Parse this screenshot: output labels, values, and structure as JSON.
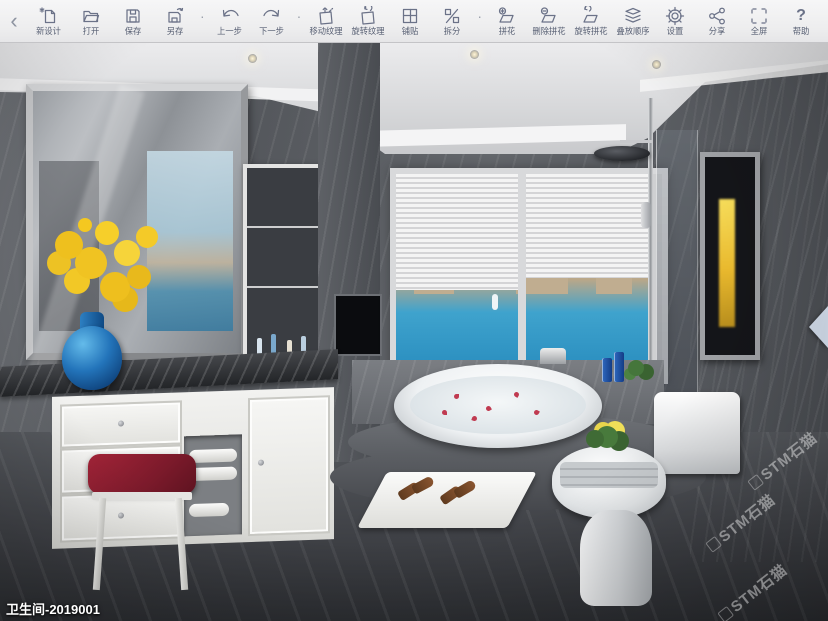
{
  "window": {
    "width": 828,
    "height": 621
  },
  "toolbar": {
    "back_glyph": "‹",
    "separator_glyph": "·",
    "help_glyph": "?",
    "groups": [
      {
        "items": [
          {
            "label": "新设计",
            "icon": "new-design-icon"
          },
          {
            "label": "打开",
            "icon": "open-folder-icon"
          },
          {
            "label": "保存",
            "icon": "save-icon"
          },
          {
            "label": "另存",
            "icon": "save-as-icon"
          }
        ]
      },
      {
        "items": [
          {
            "label": "上一步",
            "icon": "undo-icon"
          },
          {
            "label": "下一步",
            "icon": "redo-icon"
          }
        ]
      },
      {
        "items": [
          {
            "label": "移动纹理",
            "icon": "move-texture-icon"
          },
          {
            "label": "旋转纹理",
            "icon": "rotate-texture-icon"
          },
          {
            "label": "铺贴",
            "icon": "tile-paste-icon"
          },
          {
            "label": "拆分",
            "icon": "split-icon"
          }
        ]
      },
      {
        "items": [
          {
            "label": "拼花",
            "icon": "mosaic-add-icon"
          },
          {
            "label": "删除拼花",
            "icon": "mosaic-delete-icon"
          },
          {
            "label": "旋转拼花",
            "icon": "mosaic-rotate-icon"
          },
          {
            "label": "叠放顺序",
            "icon": "stack-order-icon"
          }
        ]
      }
    ],
    "right_items": [
      {
        "label": "设置",
        "icon": "settings-icon"
      },
      {
        "label": "分享",
        "icon": "share-icon"
      },
      {
        "label": "全屏",
        "icon": "fullscreen-icon"
      },
      {
        "label": "帮助",
        "icon": "help-icon"
      }
    ]
  },
  "canvas": {
    "project_label": "卫生间-2019001",
    "watermark_text": "STM石猫",
    "scene_description": "rendered bathroom with gray marble walls, white vanity, round bathtub, window, shower and toilet"
  },
  "colors": {
    "toolbar_bg": "#f0f0f1",
    "toolbar_text": "#565e72",
    "accent_yellow": "#f4c820",
    "vase_blue": "#2374ba",
    "stool_red": "#a32438",
    "expander_fill": "#dae4f2"
  }
}
